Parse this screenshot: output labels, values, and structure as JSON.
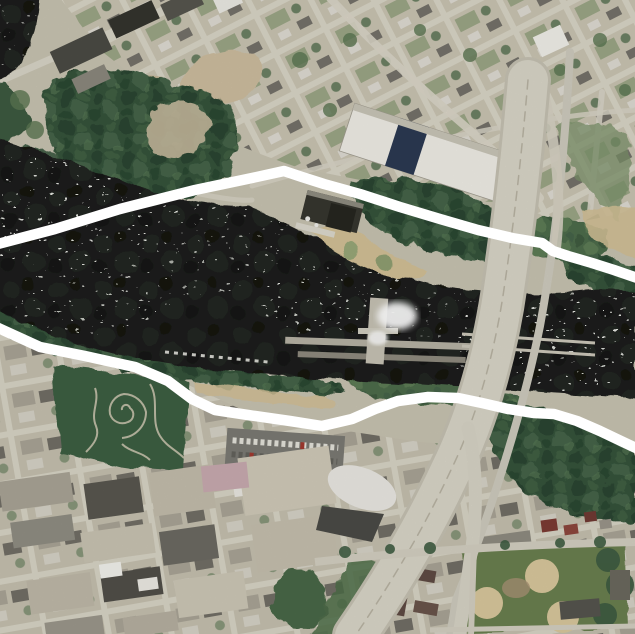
{
  "meta": {
    "width": 635,
    "height": 634,
    "kind": "aerial-satellite-photograph",
    "description": "Aerial photo of an urban river corridor with falls, a lock and dam, islands, bridges, a freeway, parks and street grids. Two thick white hand-drawn boundary lines cross the image from left to right."
  },
  "overlay": {
    "upper_boundary": {
      "points": "-6,245 55,229 120,209 195,190 252,178 284,171 302,177 324,184 360,194 400,207 440,219 478,230 512,238 542,243 553,251 568,256 592,263 614,270 640,279",
      "color": "#ffffff",
      "stroke_width": 10.5
    },
    "lower_boundary": {
      "points": "-6,326 40,347 85,356 135,367 168,381 192,399 215,410 248,415 290,421 322,426 352,419 375,409 398,401 428,397 458,398 482,403 508,409 534,413 554,414 577,421 600,431 621,441 640,450",
      "color": "#ffffff",
      "stroke_width": 10.5
    }
  },
  "palette": {
    "land_base": "#c8c3b1",
    "water_dark": "#1b1f1b",
    "rapids_white": "#eef0e9",
    "tree_dark": "#35533b",
    "tree_mid": "#4e6c4b",
    "lawn_green": "#7e9370",
    "sand_tan": "#d2c096",
    "road_light": "#d8d4c6",
    "highway_deck": "#dad6c8",
    "highway_edge": "#c6c2b3",
    "park_green": "#3d5e43",
    "park_path": "#c9c4ae",
    "ballfield_green": "#6a7f50",
    "diamond_tan": "#d9c89d",
    "warehouse_white": "#efede6",
    "warehouse_navy": "#2c3a52",
    "plant_dark_roof": "#36362f",
    "lock_wall_gray": "#b6b2a4",
    "foam_white": "#ffffff",
    "parking_gray": "#7b7a74"
  }
}
